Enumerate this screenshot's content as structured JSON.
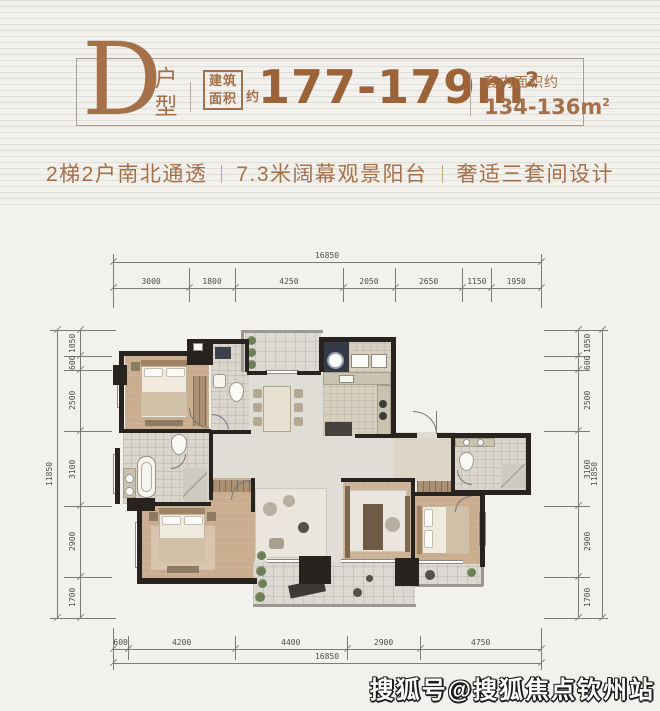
{
  "header": {
    "plan_letter": "D",
    "plan_type_label": "户型",
    "area_badge_line1": "建筑",
    "area_badge_line2": "面积",
    "area_badge_suffix": "约",
    "area_value": "177-179m",
    "area_sup": "2",
    "inner_area_label": "套内面积约",
    "inner_area_value": "134-136m",
    "inner_area_sup": "2"
  },
  "subtitle": {
    "items": [
      "2梯2户南北通透",
      "7.3米阔幕观景阳台",
      "奢适三套间设计"
    ]
  },
  "dimensions": {
    "top_total": "16850",
    "top_segments": [
      "3000",
      "1800",
      "4250",
      "2050",
      "2650",
      "1150",
      "1950"
    ],
    "bottom_segments": [
      "600",
      "4200",
      "4400",
      "2900",
      "4750"
    ],
    "bottom_total": "16850",
    "left_total": "11850",
    "left_segments": [
      "1050",
      "600",
      "2500",
      "3100",
      "2900",
      "1700"
    ],
    "right_segments": [
      "1050",
      "600",
      "2500",
      "3100",
      "2900",
      "1700"
    ],
    "right_total": "11850"
  },
  "watermark": {
    "text": "搜狐号@搜狐焦点钦州站"
  },
  "colors": {
    "accent": "#a5714a",
    "number": "#9c6238",
    "wall": "#28231e",
    "dim_line": "#7a7a7a",
    "background": "#f3f1ed"
  }
}
